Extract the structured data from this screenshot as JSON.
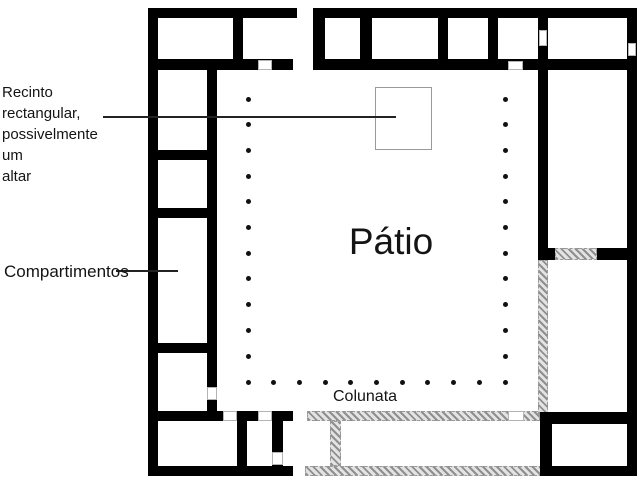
{
  "diagram_type": "archaeological-floor-plan",
  "labels": {
    "altar_note": "Recinto\nrectangular,\npossivelmente um\naltar",
    "compartments": "Compartimentos",
    "courtyard": "Pátio",
    "colonnade": "Colunata"
  },
  "colors": {
    "background": "#ffffff",
    "wall": "#000000",
    "hatch_stripe": "#8f8f8f",
    "hatch_bg": "#e3e3e3",
    "dot": "#111111",
    "leader_line": "#222222",
    "altar_outline": "#9a9a9a"
  },
  "colonnade": {
    "dot_diameter_px": 5,
    "left_column": {
      "x": 248,
      "y_start": 99,
      "spacing": 25.7,
      "count": 11
    },
    "right_column": {
      "x": 505,
      "y_start": 99,
      "spacing": 25.7,
      "count": 11
    },
    "bottom_row": {
      "y": 382,
      "x_start": 248,
      "spacing": 25.7,
      "count": 11
    }
  }
}
